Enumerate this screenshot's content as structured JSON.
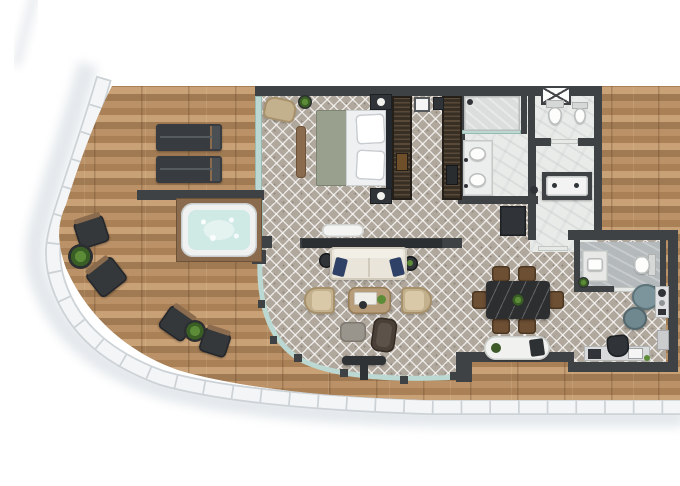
{
  "meta": {
    "description": "3D top-down architectural floor plan render of a penthouse suite with a curved wrap-around wooden terrace; no text labels are present in the image",
    "view": "top-down",
    "canvas": {
      "width": 680,
      "height": 486
    }
  },
  "palette": {
    "background": "#ffffff",
    "rim": "#f3f5f7",
    "rim_edge": "#ccd2d6",
    "rim_tick": "#c2c8cc",
    "rim_shadow": "#e0e5e9",
    "deck_wood": "#b48c63",
    "wall": "#3f4245",
    "glass": "#bcd8d2",
    "tile_base": "#b1a89d",
    "marble": "#e9ebe9",
    "marble_dark": "#b4b9bc",
    "wardrobe": "#3a3127",
    "bed_sheet": "#eef0f2",
    "bed_blanket": "#99a08d",
    "headboard": "#23272e",
    "sofa": "#e9e5db",
    "pillow_navy": "#2f4166",
    "armchair_tan": "#c3b08c",
    "table_wood": "#b79d79",
    "dining_table": "#2c2e30",
    "chair_brown": "#6d4f33",
    "daybed": "#f1f2f0",
    "hot_tub_water": "#cfe9e5",
    "plant_green": "#4e7d32",
    "lounge_teal": "#7c949b",
    "furniture_dark": "#303438"
  },
  "rooms": [
    {
      "id": "terrace",
      "furniture": [
        "sun-lounger",
        "sun-lounger",
        "hot-tub",
        "privacy-wall",
        "bistro-chair",
        "bistro-chair",
        "plant-table",
        "bistro-chair",
        "bistro-chair",
        "plant-table",
        "pedestal-table"
      ]
    },
    {
      "id": "bedroom",
      "furniture": [
        "double-bed",
        "nightstand",
        "nightstand",
        "armchair",
        "side-plant-table",
        "bench",
        "tv-bench"
      ]
    },
    {
      "id": "walk-in-closet",
      "furniture": [
        "wardrobe-row",
        "wardrobe-row",
        "storage-box",
        "storage-box"
      ]
    },
    {
      "id": "bathroom",
      "furniture": [
        "shower",
        "double-vanity",
        "toilet",
        "bidet",
        "bathtub"
      ]
    },
    {
      "id": "entry-hall",
      "furniture": [
        "entry-door",
        "cabinet"
      ]
    },
    {
      "id": "living-room",
      "furniture": [
        "sofa",
        "speaker",
        "speaker",
        "coffee-table",
        "armchair",
        "armchair",
        "ottoman",
        "lounge-chair",
        "daybed"
      ]
    },
    {
      "id": "dining-area",
      "furniture": [
        "dining-table",
        "dining-chair",
        "dining-chair",
        "dining-chair",
        "dining-chair",
        "dining-chair",
        "dining-chair"
      ]
    },
    {
      "id": "powder-room",
      "furniture": [
        "vanity",
        "toilet",
        "plant"
      ]
    },
    {
      "id": "lounge-corner",
      "furniture": [
        "swivel-chair",
        "swivel-chair",
        "minibar",
        "shelf"
      ]
    },
    {
      "id": "office-nook",
      "furniture": [
        "desk",
        "desk-chair",
        "printer",
        "plant"
      ]
    }
  ]
}
